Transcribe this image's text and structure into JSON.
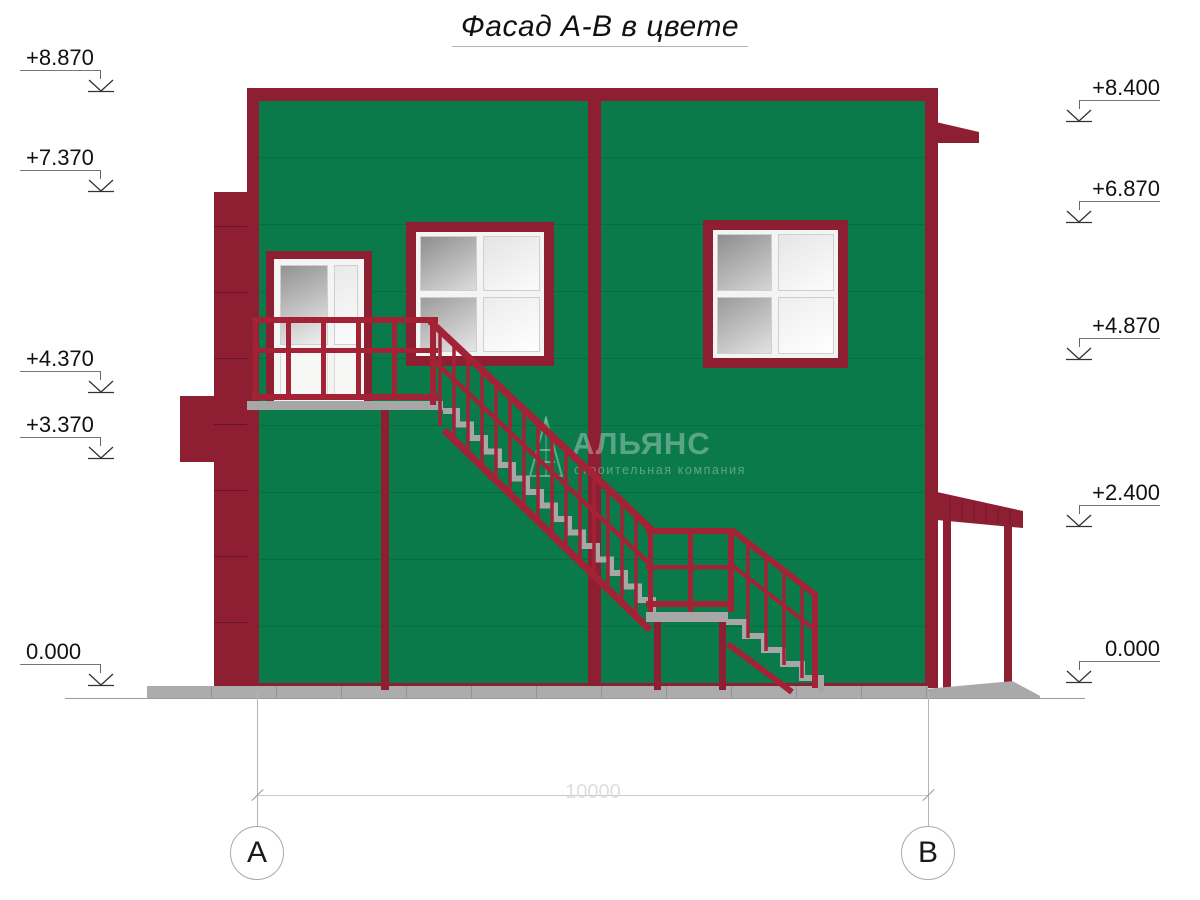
{
  "title": {
    "text": "Фасад А-В в цвете"
  },
  "colors": {
    "facade_green": "#0a7a4a",
    "facade_seam": "#06603a",
    "trim_maroon": "#8e1e32",
    "railing_red": "#a32236",
    "steps_gray": "#a7a7a7",
    "base_gray": "#acacac",
    "glass_dark": "#929292",
    "glass_light": "#f7f7f7"
  },
  "elevation_markers_left": [
    {
      "value": "+8.870"
    },
    {
      "value": "+7.370"
    },
    {
      "value": "+4.370"
    },
    {
      "value": "+3.370"
    },
    {
      "value": "0.000"
    }
  ],
  "elevation_markers_right": [
    {
      "value": "+8.400"
    },
    {
      "value": "+6.870"
    },
    {
      "value": "+4.870"
    },
    {
      "value": "+2.400"
    },
    {
      "value": "0.000"
    }
  ],
  "dimension": {
    "value": "10000"
  },
  "axes": [
    {
      "label": "А"
    },
    {
      "label": "В"
    }
  ],
  "watermark": {
    "name": "АЛЬЯНС",
    "tagline": "строительная компания"
  }
}
